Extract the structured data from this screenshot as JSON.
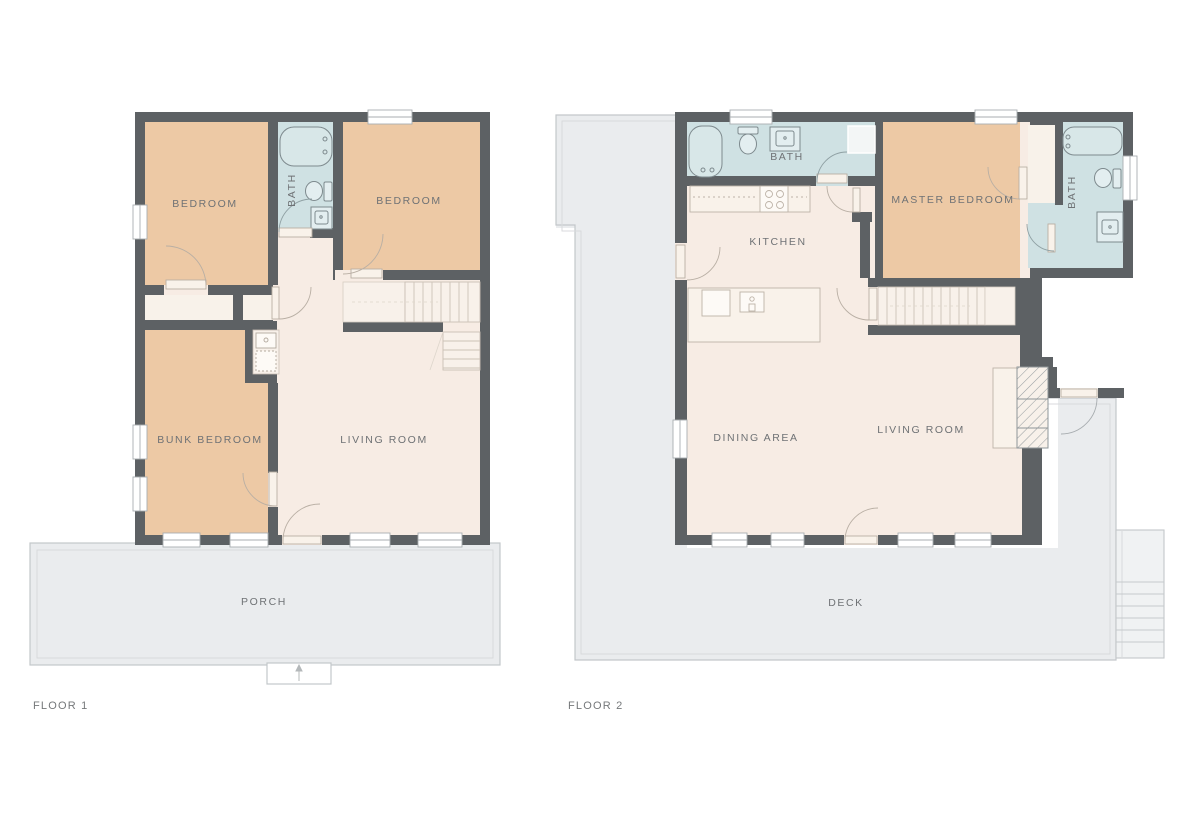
{
  "palette": {
    "wall": "#5d6164",
    "bedroom_fill": "#edc9a5",
    "bath_fill": "#cfe1e3",
    "interior_fill": "#f7ece4",
    "closet_fill": "#f8f2ea",
    "outdoor_fill": "#e9ebed",
    "outdoor_outline": "#c3c7ca",
    "fixture_outline": "#7e8a8e",
    "furniture_outline": "#bcb2a7",
    "label_text": "#6f7275"
  },
  "floor1": {
    "title": "FLOOR 1",
    "bedroom_left": "BEDROOM",
    "bedroom_right": "BEDROOM",
    "bath": "BATH",
    "bunk_bedroom": "BUNK BEDROOM",
    "living_room": "LIVING ROOM",
    "porch": "PORCH"
  },
  "floor2": {
    "title": "FLOOR 2",
    "bath_top": "BATH",
    "bath_right": "BATH",
    "kitchen": "KITCHEN",
    "master_bedroom": "MASTER BEDROOM",
    "dining_area": "DINING AREA",
    "living_room": "LIVING ROOM",
    "deck": "DECK"
  }
}
